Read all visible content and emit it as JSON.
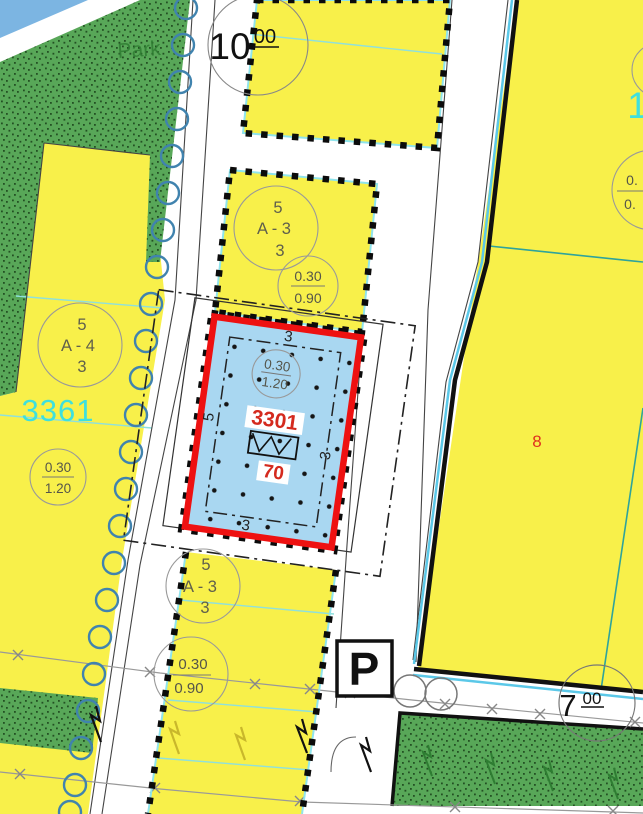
{
  "map": {
    "park_label": "Park",
    "street_top": {
      "num": "10",
      "sup": "00"
    },
    "street_bottom": {
      "num": "7",
      "sup": "00"
    },
    "parking": "P",
    "left_block_number": "3361",
    "right_block_number_cut": "1",
    "right_parcel_number": "8",
    "focus_parcel": {
      "number": "3301",
      "area": "70",
      "setback_top": "3",
      "setback_left": "5",
      "setback_right": "3",
      "setback_bottom": "3"
    },
    "zone_a3": {
      "l1": "5",
      "l2": "A - 3",
      "l3": "3"
    },
    "zone_a4": {
      "l1": "5",
      "l2": "A - 4",
      "l3": "3"
    },
    "coef_090": {
      "top": "0.30",
      "bottom": "0.90"
    },
    "coef_120": {
      "top": "0.30",
      "bottom": "1.20"
    },
    "coef_cut": {
      "top": "0.",
      "bottom": "0."
    },
    "colors": {
      "parcel_fill": "#A9D7F1",
      "boundary_red": "#EE1111",
      "parcel_yellow": "#F8F04A",
      "green_area": "#58A758",
      "cyan_text": "#3EE0DE",
      "red_text": "#D42A1E"
    }
  }
}
